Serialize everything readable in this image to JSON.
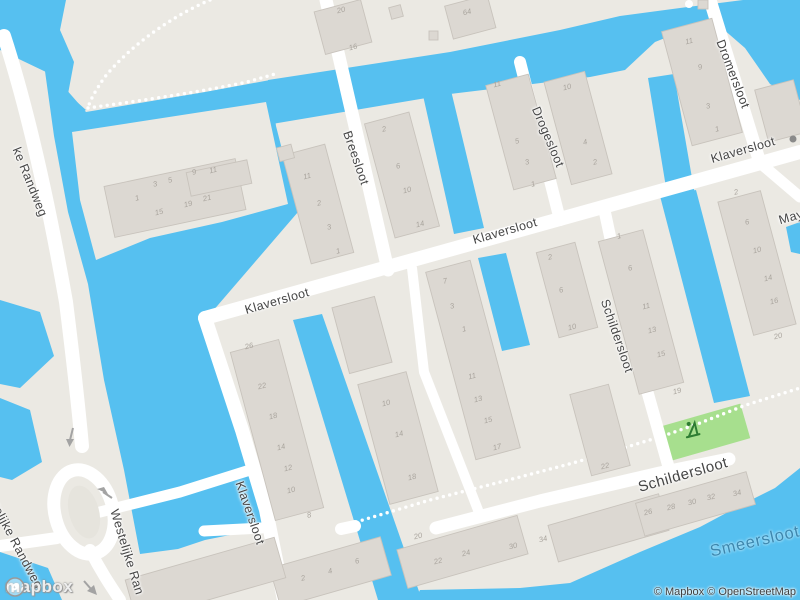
{
  "map": {
    "colors": {
      "water": "#56C0F0",
      "land": "#EBE9E3",
      "road": "#FFFFFF",
      "building_fill": "#DCD8D2",
      "building_stroke": "#C8C3BC",
      "park": "#A7DF8E",
      "park_icon": "#2E7D32",
      "street_label": "#454545",
      "water_label": "#3D87AE",
      "building_number": "#A9A49D",
      "oneway_arrow": "#A3A3A3"
    },
    "icons": {
      "playground": "playground-icon",
      "oneway": "oneway-arrow-icon",
      "logo_mark": "mapbox-logo-icon",
      "poi": "poi-icon"
    },
    "street_labels": [
      {
        "text": "ke Randweg",
        "x": 30,
        "y": 182,
        "rot": 68,
        "cls": "street"
      },
      {
        "text": "estelijke Randweg",
        "x": 14,
        "y": 540,
        "rot": 62,
        "cls": "street"
      },
      {
        "text": "Westelijke Ran",
        "x": 127,
        "y": 552,
        "rot": 73,
        "cls": "street"
      },
      {
        "text": "Breesloot",
        "x": 356,
        "y": 158,
        "rot": 71,
        "cls": "street"
      },
      {
        "text": "Klaversloot",
        "x": 277,
        "y": 301,
        "rot": -16,
        "cls": "street"
      },
      {
        "text": "Klaversloot",
        "x": 505,
        "y": 231,
        "rot": -16,
        "cls": "street"
      },
      {
        "text": "Klaversloot",
        "x": 743,
        "y": 150,
        "rot": -16,
        "cls": "street"
      },
      {
        "text": "Klaversloot",
        "x": 250,
        "y": 513,
        "rot": 71,
        "cls": "street"
      },
      {
        "text": "Drogesloot",
        "x": 548,
        "y": 137,
        "rot": 67,
        "cls": "street"
      },
      {
        "text": "Dromersloot",
        "x": 733,
        "y": 74,
        "rot": 69,
        "cls": "street"
      },
      {
        "text": "Schildersloot",
        "x": 617,
        "y": 336,
        "rot": 71,
        "cls": "street"
      },
      {
        "text": "Schildersloot",
        "x": 683,
        "y": 475,
        "rot": -16,
        "cls": "street-lg"
      },
      {
        "text": "May",
        "x": 791,
        "y": 217,
        "rot": -16,
        "cls": "street"
      }
    ],
    "water_labels": [
      {
        "text": "Smeersloot",
        "x": 755,
        "y": 542,
        "rot": -13
      }
    ],
    "building_numbers": [
      {
        "t": "1",
        "x": 137,
        "y": 198
      },
      {
        "t": "3",
        "x": 155,
        "y": 184
      },
      {
        "t": "5",
        "x": 170,
        "y": 180
      },
      {
        "t": "9",
        "x": 194,
        "y": 172
      },
      {
        "t": "11",
        "x": 213,
        "y": 170
      },
      {
        "t": "15",
        "x": 159,
        "y": 212
      },
      {
        "t": "19",
        "x": 188,
        "y": 204
      },
      {
        "t": "21",
        "x": 207,
        "y": 198
      },
      {
        "t": "20",
        "x": 341,
        "y": 10
      },
      {
        "t": "16",
        "x": 353,
        "y": 47
      },
      {
        "t": "64",
        "x": 467,
        "y": 12
      },
      {
        "t": "11",
        "x": 307,
        "y": 176
      },
      {
        "t": "2",
        "x": 319,
        "y": 203
      },
      {
        "t": "3",
        "x": 329,
        "y": 227
      },
      {
        "t": "1",
        "x": 338,
        "y": 251
      },
      {
        "t": "2",
        "x": 384,
        "y": 129
      },
      {
        "t": "6",
        "x": 398,
        "y": 166
      },
      {
        "t": "10",
        "x": 407,
        "y": 190
      },
      {
        "t": "14",
        "x": 420,
        "y": 224
      },
      {
        "t": "11",
        "x": 497,
        "y": 84
      },
      {
        "t": "5",
        "x": 517,
        "y": 141
      },
      {
        "t": "3",
        "x": 527,
        "y": 162
      },
      {
        "t": "1",
        "x": 533,
        "y": 184
      },
      {
        "t": "10",
        "x": 567,
        "y": 87
      },
      {
        "t": "4",
        "x": 585,
        "y": 142
      },
      {
        "t": "2",
        "x": 595,
        "y": 162
      },
      {
        "t": "11",
        "x": 689,
        "y": 41
      },
      {
        "t": "9",
        "x": 700,
        "y": 67
      },
      {
        "t": "3",
        "x": 708,
        "y": 106
      },
      {
        "t": "1",
        "x": 717,
        "y": 129
      },
      {
        "t": "2",
        "x": 736,
        "y": 192
      },
      {
        "t": "6",
        "x": 747,
        "y": 222
      },
      {
        "t": "10",
        "x": 757,
        "y": 250
      },
      {
        "t": "14",
        "x": 768,
        "y": 278
      },
      {
        "t": "16",
        "x": 774,
        "y": 301
      },
      {
        "t": "20",
        "x": 778,
        "y": 336
      },
      {
        "t": "1",
        "x": 619,
        "y": 236
      },
      {
        "t": "6",
        "x": 630,
        "y": 268
      },
      {
        "t": "11",
        "x": 646,
        "y": 306
      },
      {
        "t": "13",
        "x": 652,
        "y": 330
      },
      {
        "t": "15",
        "x": 661,
        "y": 354
      },
      {
        "t": "19",
        "x": 677,
        "y": 391
      },
      {
        "t": "2",
        "x": 550,
        "y": 257
      },
      {
        "t": "6",
        "x": 561,
        "y": 290
      },
      {
        "t": "10",
        "x": 572,
        "y": 327
      },
      {
        "t": "22",
        "x": 605,
        "y": 466
      },
      {
        "t": "7",
        "x": 445,
        "y": 281
      },
      {
        "t": "3",
        "x": 452,
        "y": 306
      },
      {
        "t": "1",
        "x": 464,
        "y": 329
      },
      {
        "t": "11",
        "x": 472,
        "y": 376
      },
      {
        "t": "13",
        "x": 478,
        "y": 399
      },
      {
        "t": "15",
        "x": 488,
        "y": 420
      },
      {
        "t": "17",
        "x": 497,
        "y": 447
      },
      {
        "t": "26",
        "x": 249,
        "y": 346
      },
      {
        "t": "22",
        "x": 262,
        "y": 386
      },
      {
        "t": "18",
        "x": 273,
        "y": 416
      },
      {
        "t": "14",
        "x": 281,
        "y": 447
      },
      {
        "t": "12",
        "x": 288,
        "y": 468
      },
      {
        "t": "10",
        "x": 291,
        "y": 490
      },
      {
        "t": "8",
        "x": 309,
        "y": 515
      },
      {
        "t": "10",
        "x": 386,
        "y": 403
      },
      {
        "t": "14",
        "x": 399,
        "y": 434
      },
      {
        "t": "18",
        "x": 412,
        "y": 477
      },
      {
        "t": "2",
        "x": 303,
        "y": 578
      },
      {
        "t": "4",
        "x": 330,
        "y": 571
      },
      {
        "t": "6",
        "x": 357,
        "y": 561
      },
      {
        "t": "20",
        "x": 418,
        "y": 536
      },
      {
        "t": "22",
        "x": 438,
        "y": 561
      },
      {
        "t": "24",
        "x": 466,
        "y": 553
      },
      {
        "t": "30",
        "x": 513,
        "y": 546
      },
      {
        "t": "34",
        "x": 543,
        "y": 539
      },
      {
        "t": "26",
        "x": 648,
        "y": 512
      },
      {
        "t": "28",
        "x": 671,
        "y": 507
      },
      {
        "t": "30",
        "x": 692,
        "y": 502
      },
      {
        "t": "32",
        "x": 711,
        "y": 497
      },
      {
        "t": "34",
        "x": 737,
        "y": 493
      }
    ]
  },
  "attribution": {
    "text": "© Mapbox © OpenStreetMap"
  },
  "logo": {
    "text": "mapbox"
  }
}
